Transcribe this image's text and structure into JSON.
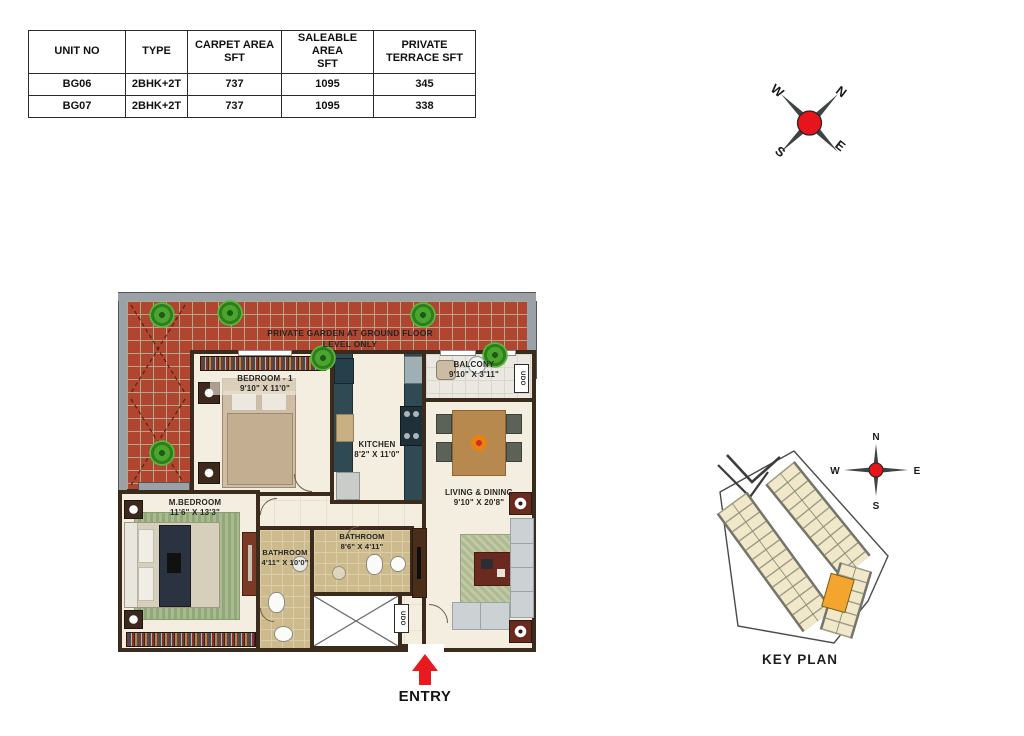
{
  "unit_table": {
    "headers": [
      {
        "l1": "UNIT NO",
        "l2": ""
      },
      {
        "l1": "TYPE",
        "l2": ""
      },
      {
        "l1": "CARPET AREA",
        "l2": "SFT"
      },
      {
        "l1": "SALEABLE  AREA",
        "l2": "SFT"
      },
      {
        "l1": "PRIVATE",
        "l2": "TERRACE  SFT"
      }
    ],
    "rows": [
      [
        "BG06",
        "2BHK+2T",
        "737",
        "1095",
        "345"
      ],
      [
        "BG07",
        "2BHK+2T",
        "737",
        "1095",
        "338"
      ]
    ]
  },
  "compass": {
    "n": "N",
    "e": "E",
    "s": "S",
    "w": "W"
  },
  "floor_plan": {
    "garden_note": {
      "line1": "PRIVATE GARDEN AT GROUND FLOOR",
      "line2": "LEVEL ONLY"
    },
    "rooms": {
      "bedroom1": {
        "name": "BEDROOM - 1",
        "dims": "9'10\" X 11'0\""
      },
      "kitchen": {
        "name": "KITCHEN",
        "dims": "8'2\" X 11'0\""
      },
      "balcony": {
        "name": "BALCONY",
        "dims": "9'10\" X 3'11\""
      },
      "living_dining": {
        "name": "LIVING & DINING",
        "dims": "9'10\" X 20'8\""
      },
      "master_bedroom": {
        "name": "M.BEDROOM",
        "dims": "11'6\" X 13'3\""
      },
      "bathroom1": {
        "name": "BATHROOM",
        "dims": "4'11\" X 10'0\""
      },
      "bathroom2": {
        "name": "BATHROOM",
        "dims": "8'6\" X 4'11\""
      }
    },
    "duct_label": "UDO",
    "entry_label": "ENTRY"
  },
  "key_plan": {
    "title": "KEY PLAN"
  },
  "colors": {
    "garden_red": "#b04530",
    "wall_brown": "#3b2b1c",
    "accent_red": "#e8191f",
    "counter_teal": "#2f4a52",
    "bath_tan": "#cdbb8e",
    "floor_cream": "#f4eee0",
    "highlight_orange": "#f3a52f",
    "building_beige": "#f1e8ca"
  }
}
